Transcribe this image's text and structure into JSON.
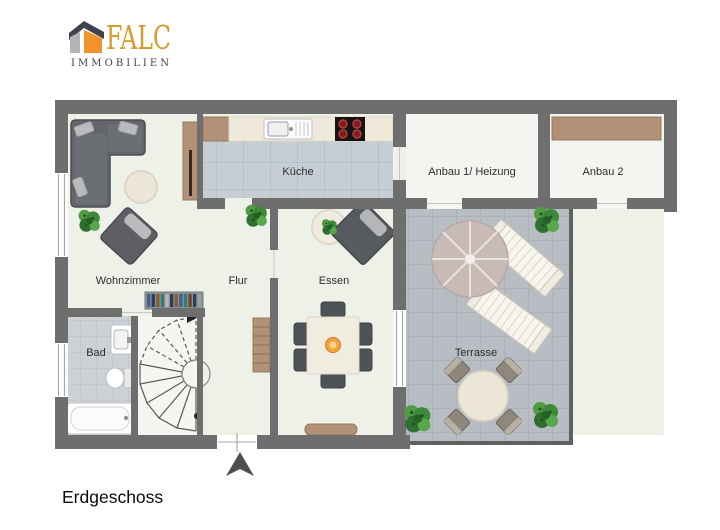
{
  "logo": {
    "brand": "FALC",
    "subtitle": "IMMOBILIEN"
  },
  "floor_label": "Erdgeschoss",
  "rooms": {
    "wohnzimmer": {
      "label": "Wohnzimmer"
    },
    "bad": {
      "label": "Bad"
    },
    "flur": {
      "label": "Flur"
    },
    "kueche": {
      "label": "Küche"
    },
    "essen": {
      "label": "Essen"
    },
    "anbau1": {
      "label": "Anbau 1/ Heizung"
    },
    "anbau2": {
      "label": "Anbau 2"
    },
    "terrasse": {
      "label": "Terrasse"
    }
  },
  "colors": {
    "wall": "#6e6e6e",
    "floor": "#edf1e8",
    "annex_floor": "#f3f5f0",
    "stairs_floor": "#f4f7f1",
    "kitchen_tile": "#c6cdd4",
    "bath_tile": "#ccd1d6",
    "terrace_tile": "#b7bdc3",
    "wood": "#b29176",
    "sofa_gray": "#5f6166",
    "plant_green": "#3c8a36",
    "bowl_orange": "#f2a33c",
    "logo_gold": "#d89a28",
    "logo_orange": "#f0932a",
    "logo_gray": "#b3b3b3",
    "logo_dark": "#3d4450",
    "label_text": "#2e2e2e"
  }
}
